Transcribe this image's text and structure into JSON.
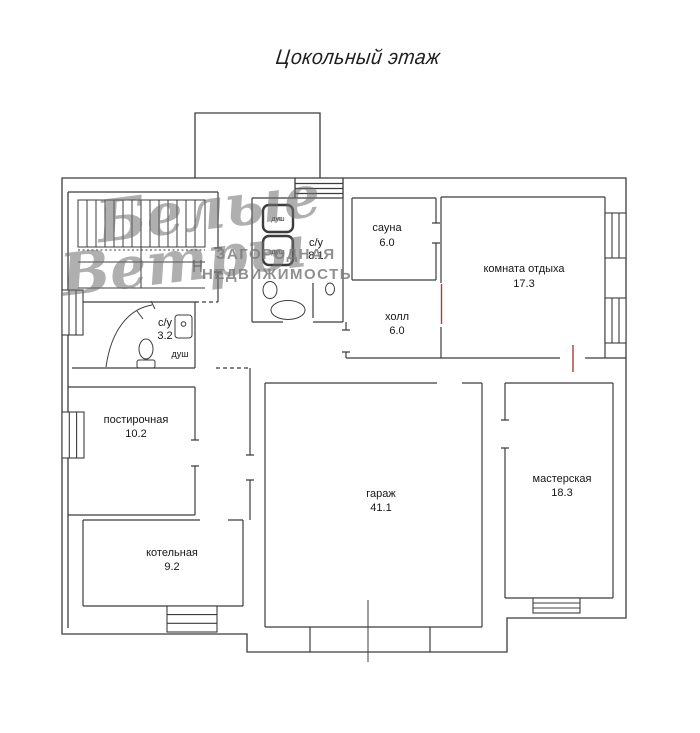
{
  "title": "Цокольный этаж",
  "watermark": {
    "script_word1": "Белые",
    "script_word2": "Ветры",
    "caps_line1": "ЗАГОРОДНАЯ",
    "caps_line2": "НЕДВИЖИМОСТЬ"
  },
  "colors": {
    "wall": "#3c3c3c",
    "door_mark": "#b23a3a",
    "watermark_gray": "#7d7d7d"
  },
  "rooms": [
    {
      "name": "сауна",
      "area": "6.0"
    },
    {
      "name": "комната отдыха",
      "area": "17.3"
    },
    {
      "name": "с/у",
      "area": "8.1"
    },
    {
      "name": "холл",
      "area": "6.0"
    },
    {
      "name": "с/у",
      "area": "3.2"
    },
    {
      "name": "постирочная",
      "area": "10.2"
    },
    {
      "name": "котельная",
      "area": "9.2"
    },
    {
      "name": "гараж",
      "area": "41.1"
    },
    {
      "name": "мастерская",
      "area": "18.3"
    }
  ],
  "fixtures": {
    "shower_stall_1": "душ",
    "shower_stall_2": "душ",
    "shower_corner": "душ"
  }
}
